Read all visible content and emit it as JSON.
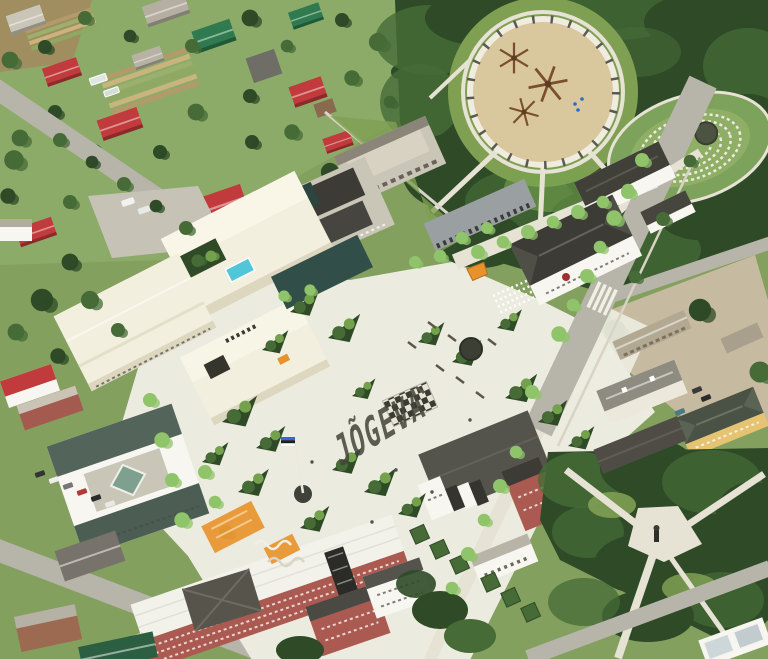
{
  "scene": {
    "kind": "aerial-photo-rendering",
    "plaza": {
      "pavement_text": "JÕGEVA"
    }
  },
  "palette": {
    "grass": "#83a05e",
    "lawn": "#8cab68",
    "lawn_bright": "#7fa053",
    "tree_dark": "#2e4a27",
    "tree_mid": "#466b37",
    "tree_light": "#74a24c",
    "tree_lime": "#8fc46a",
    "plaza": "#ecebdf",
    "path": "#e6e2d4",
    "road": "#b7b4aa",
    "building_cream": "#f2efde",
    "building_cream_light": "#faf8ea",
    "building_cream_shade": "#ddd7bf",
    "glass_dark": "#314f48",
    "pool": "#52c6d9",
    "roof_red": "#c13a3c",
    "roof_dark": "#3c3b35",
    "roof_gray": "#8e8b80",
    "brick": "#aa5a50",
    "roof_white": "#f3f2ea",
    "sand": "#d9c79e",
    "orange": "#e8922d",
    "flag_blue": "#2a6bd6",
    "flag_black": "#1d1d1d",
    "flag_white": "#ffffff",
    "letters": "#42453a",
    "concrete": "#c9c5b7",
    "wall_white": "#f7f6f0",
    "yellow_wall": "#e5c372",
    "roof_green": "#2f6b4b",
    "dirt": "#c6bba1"
  },
  "features": [
    "residential-district",
    "allotment-gardens",
    "forest-park",
    "circular-playground",
    "climbing-nets",
    "sunken-amphitheatre",
    "manor-building",
    "school-building",
    "garage-building",
    "colonnade-building",
    "proposed-culture-centre",
    "rooftop-pool",
    "courtyard-garden",
    "town-square",
    "pavement-lettering",
    "fountain",
    "flagpole-with-estonian-flag",
    "giant-chessboard",
    "event-chair-rows",
    "orange-playcourts",
    "orange-kiosk",
    "tree-islands",
    "civic-building",
    "east-yards",
    "yellow-house",
    "apartment-block",
    "community-building",
    "brick-school",
    "office-building",
    "parking-lot",
    "memorial-park",
    "monument",
    "main-street",
    "pedestrian-alley",
    "crosswalk",
    "street-trees",
    "glass-pavilion"
  ]
}
